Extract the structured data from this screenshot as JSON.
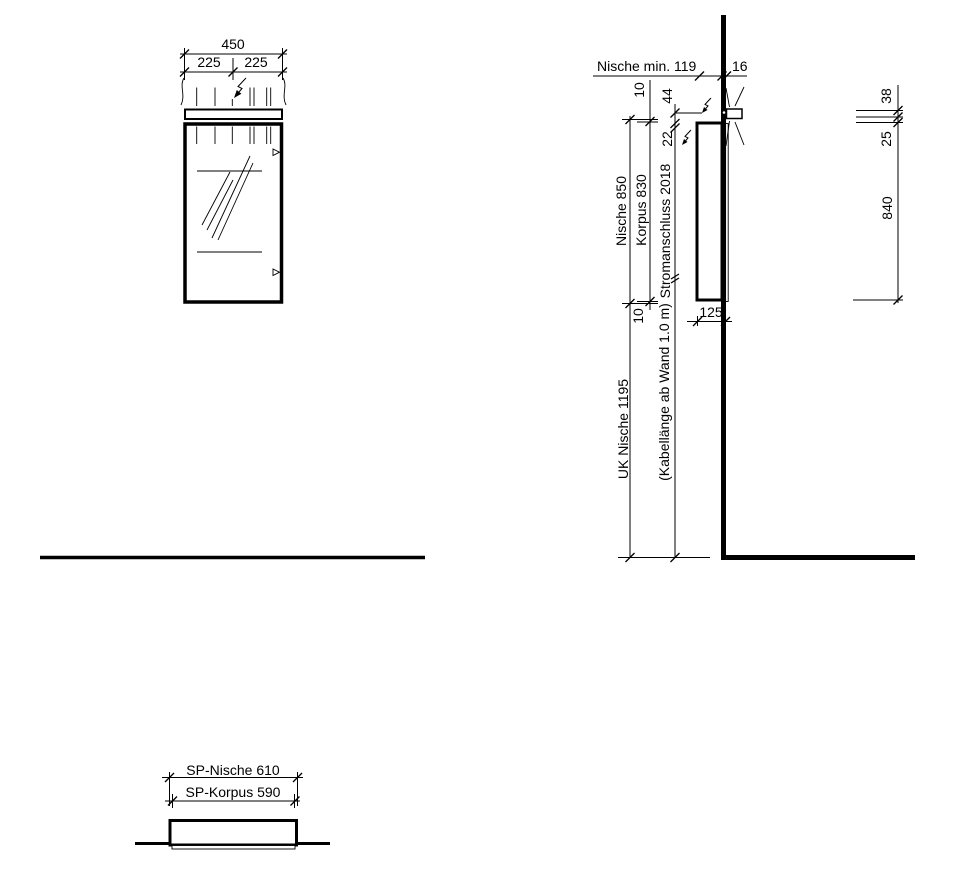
{
  "colors": {
    "line": "#000000",
    "background": "#ffffff",
    "text": "#000000"
  },
  "front_view": {
    "width_total": "450",
    "width_left": "225",
    "width_right": "225"
  },
  "side_view": {
    "niche_min_depth": "Nische min. 119",
    "wall_thickness": "16",
    "offset_top": "10",
    "light_offset": "44",
    "connection_offset": "22",
    "niche_height": "Nische 850",
    "korpus_height": "Korpus 830",
    "power_connection": "Stromanschluss 2018",
    "offset_bottom": "10",
    "cabinet_depth": "125",
    "niche_bottom_edge": "UK Nische 1195",
    "cable_note": "(Kabellänge ab Wand 1.0 m)",
    "light_height": "38",
    "gap_light_door": "25",
    "door_height": "840"
  },
  "bottom_view": {
    "niche_width": "SP-Nische 610",
    "korpus_width": "SP-Korpus 590"
  }
}
